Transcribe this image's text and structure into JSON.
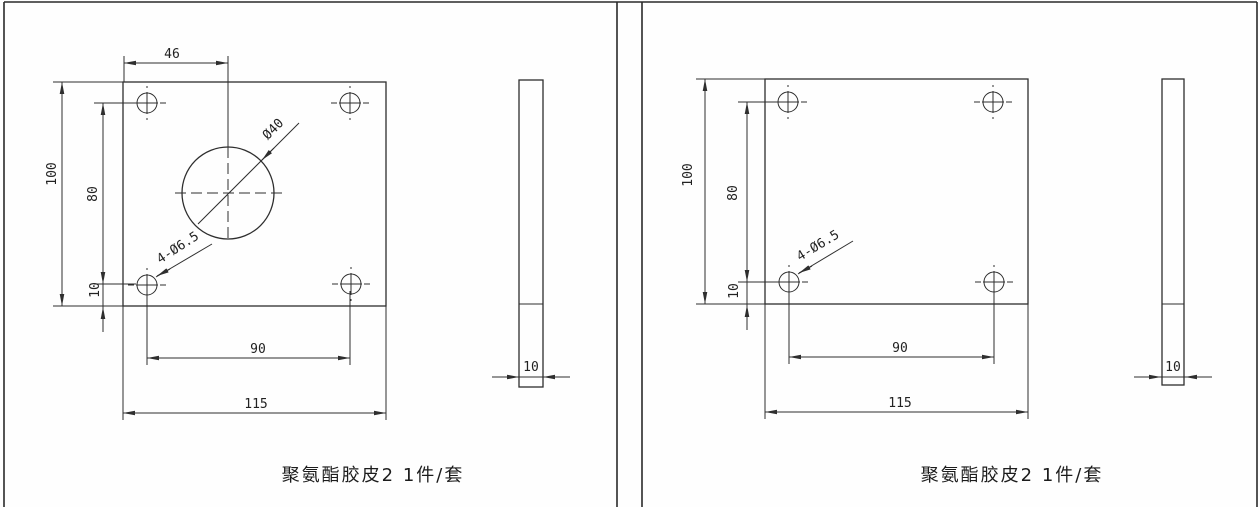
{
  "colors": {
    "line": "#2e2e2e",
    "background": "#ffffff",
    "text": "#222222"
  },
  "drawings": [
    {
      "name": "left-plate-with-center-hole",
      "caption": "聚氨酯胶皮2 1件/套",
      "dims": {
        "center_offset": "46",
        "plate_height": "100",
        "hole_row_span": "80",
        "hole_bottom_offset": "10",
        "hole_col_span": "90",
        "plate_width": "115",
        "center_hole_dia": "Ø40",
        "corner_holes": "4-Ø6.5",
        "thickness": "10"
      }
    },
    {
      "name": "right-plate-no-center-hole",
      "caption": "聚氨酯胶皮2 1件/套",
      "dims": {
        "plate_height": "100",
        "hole_row_span": "80",
        "hole_bottom_offset": "10",
        "hole_col_span": "90",
        "plate_width": "115",
        "corner_holes": "4-Ø6.5",
        "thickness": "10"
      }
    }
  ]
}
